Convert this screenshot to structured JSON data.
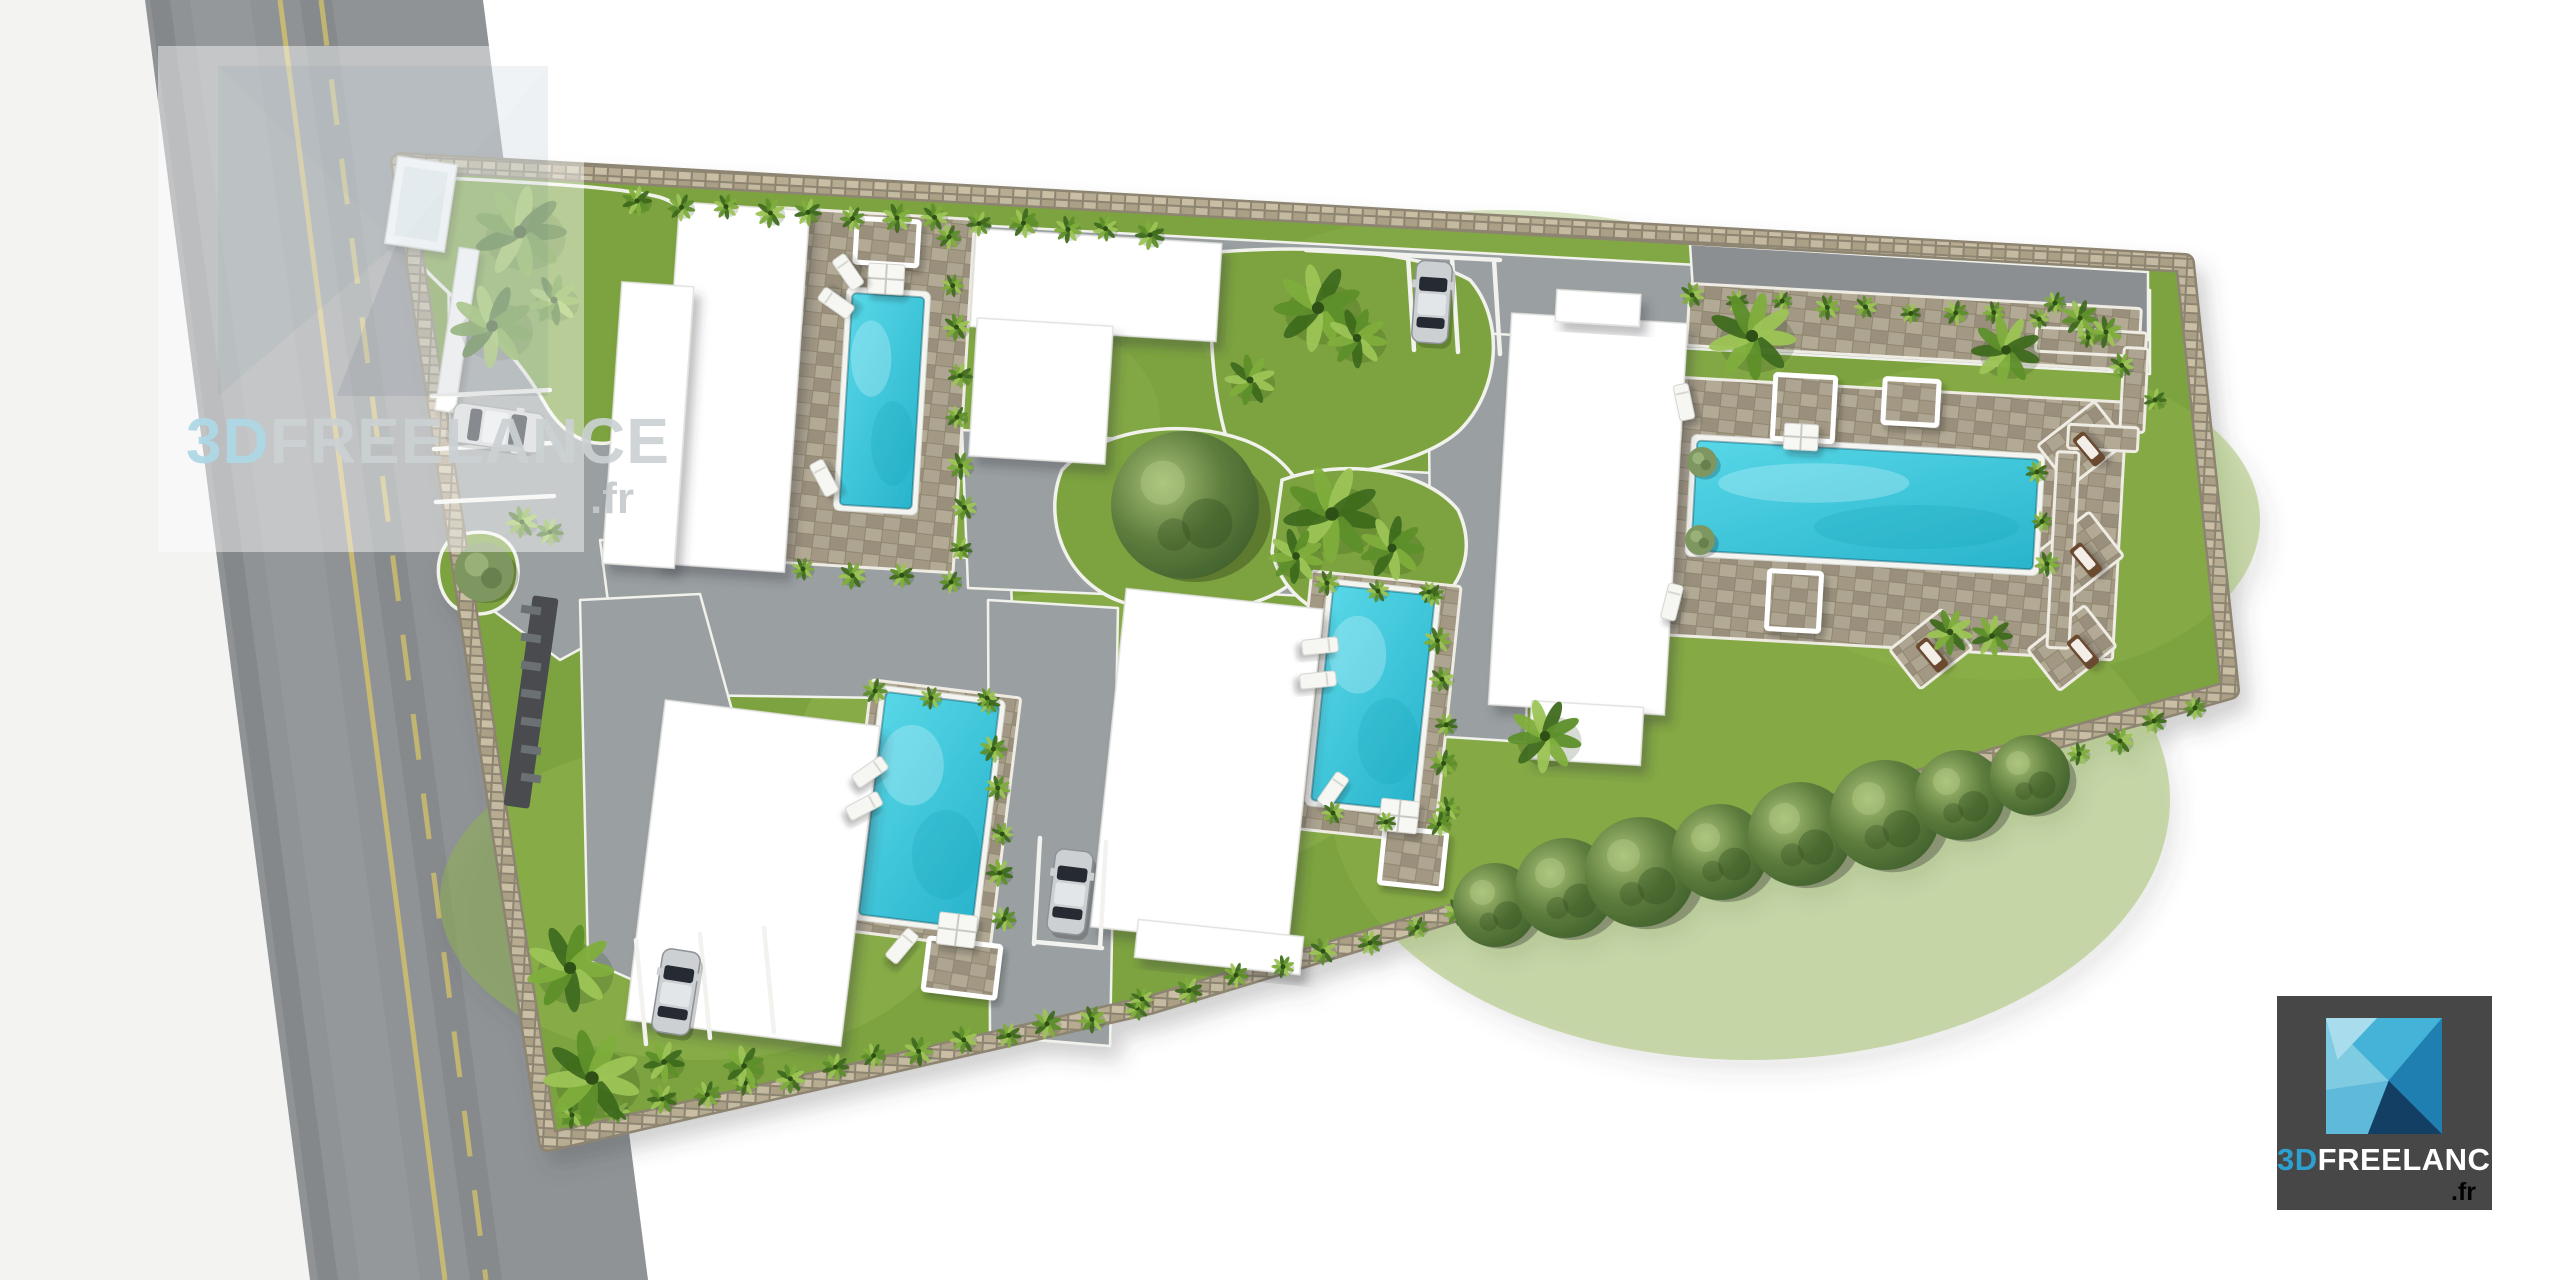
{
  "watermark": {
    "brand_3d": "3D",
    "brand_rest": "FREELANCE",
    "domain": ".fr"
  },
  "logo": {
    "brand_3d": "3D",
    "brand_rest": "FREELANCE",
    "domain": ".fr"
  },
  "palette": {
    "lawn": "#7ca33f",
    "lawn_light": "#8fb24c",
    "drive": "#9aa0a2",
    "drive_dark": "#8b8f92",
    "road": "#8f9396",
    "road_line": "#d2c06c",
    "pool_light": "#57d7e7",
    "pool_dark": "#29b4cc",
    "deck": "#a39a86",
    "wall": "#958d79",
    "wall_light": "#c4baa1",
    "building": "#ffffff",
    "curb": "#f2f2ec",
    "accent_blue": "#2da0cf",
    "logo_bg": "#474747"
  },
  "scene": {
    "road": {
      "pts": "145,0 483,0 648,1280 310,1280",
      "line_solid": [
        280,
        0,
        445,
        1280
      ],
      "line_dashed": [
        321,
        0,
        486,
        1280
      ]
    },
    "site": {
      "pts": "400,162 2185,263 2230,690 1530,890 1150,1005 548,1142"
    },
    "drives": [
      {
        "pts": "448,196 2150,290 2150,374 448,280"
      },
      {
        "pts": "448,252 628,238 652,610 560,660 452,580"
      },
      {
        "pts": "600,540 1010,560 1016,700 620,694"
      },
      {
        "pts": "962,430 1236,445 1240,600 968,588"
      },
      {
        "pts": "1225,462 1452,474 1456,604 1230,592"
      },
      {
        "pts": "1428,330 1532,336 1526,742 1432,736"
      },
      {
        "pts": "988,600 1118,608 1110,1046 990,1036"
      },
      {
        "pts": "580,600 700,594 790,920 700,1010 588,960"
      },
      {
        "pts": "1690,244 2148,272 2148,340 1694,306",
        "dark": true
      }
    ],
    "islands": [
      {
        "d": "M410,176 C520,182 610,186 655,196 C705,207 702,262 668,300 C642,332 652,378 650,420 C606,462 566,442 544,402 C506,336 456,304 422,266 C410,236 406,200 410,176 Z"
      },
      {
        "d": "M452,538 C492,522 520,540 518,574 C516,606 488,622 460,610 C436,600 430,556 452,538 Z"
      },
      {
        "d": "M1218,252 C1320,244 1420,252 1470,280 C1505,320 1500,390 1460,430 C1420,468 1300,490 1240,470 C1210,420 1205,300 1218,252 Z"
      },
      {
        "d": "M1062,470 C1102,428 1182,418 1244,440 C1304,462 1324,520 1302,572 C1272,612 1182,622 1122,602 C1064,582 1042,518 1062,470 Z"
      },
      {
        "d": "M1282,480 C1342,458 1424,468 1458,510 C1482,560 1452,612 1392,622 C1332,630 1284,602 1272,552 Z"
      }
    ],
    "decks": [
      [
        762,
        213,
        202,
        354,
        3.5
      ],
      [
        1616,
        388,
        504,
        258,
        3.2
      ],
      [
        1688,
        296,
        452,
        62,
        3.2
      ],
      [
        1298,
        578,
        150,
        258,
        6
      ],
      [
        856,
        688,
        150,
        252,
        7
      ],
      [
        2046,
        418,
        72,
        52,
        -38
      ],
      [
        2042,
        528,
        72,
        56,
        -38
      ],
      [
        2036,
        622,
        72,
        52,
        -38
      ],
      [
        1898,
        624,
        66,
        50,
        -38
      ],
      [
        2036,
        330,
        110,
        24,
        3
      ],
      [
        2122,
        348,
        24,
        84,
        3
      ],
      [
        2068,
        426,
        70,
        24,
        3
      ],
      [
        2052,
        452,
        22,
        196,
        3
      ]
    ],
    "pools": [
      [
        846,
        295,
        72,
        212,
        3.5
      ],
      [
        1694,
        450,
        342,
        110,
        3.2
      ],
      [
        1322,
        590,
        102,
        216,
        6
      ],
      [
        872,
        698,
        114,
        224,
        7
      ]
    ],
    "buildings": [
      [
        667,
        206,
        130,
        362,
        4
      ],
      [
        612,
        284,
        72,
        282,
        4
      ],
      [
        973,
        236,
        246,
        98,
        3.5
      ],
      [
        973,
        322,
        136,
        138,
        3.5
      ],
      [
        1500,
        318,
        176,
        392,
        3.4
      ],
      [
        1556,
        292,
        84,
        32,
        3.4
      ],
      [
        1530,
        704,
        112,
        58,
        3.4
      ],
      [
        1108,
        598,
        198,
        340,
        6
      ],
      [
        1136,
        928,
        166,
        38,
        6
      ],
      [
        645,
        712,
        216,
        322,
        7
      ]
    ],
    "pergolas": [
      [
        856,
        220,
        62,
        44,
        3.5
      ],
      [
        1774,
        376,
        60,
        64,
        3.2
      ],
      [
        1884,
        380,
        54,
        44,
        3.2
      ],
      [
        1768,
        572,
        52,
        58,
        3.2
      ],
      [
        1382,
        830,
        62,
        56,
        6
      ],
      [
        926,
        942,
        72,
        52,
        7
      ]
    ],
    "tables": [
      [
        868,
        264,
        36,
        30,
        3.5
      ],
      [
        1784,
        424,
        34,
        26,
        3.2
      ],
      [
        1380,
        800,
        38,
        32,
        6
      ],
      [
        938,
        914,
        38,
        32,
        7
      ]
    ],
    "loungers": [
      [
        848,
        272,
        -35,
        "w"
      ],
      [
        836,
        303,
        -55,
        "w"
      ],
      [
        824,
        478,
        -28,
        "w"
      ],
      [
        1684,
        402,
        -12,
        "w"
      ],
      [
        1672,
        602,
        14,
        "w"
      ],
      [
        2089,
        449,
        -40,
        "b"
      ],
      [
        2086,
        560,
        -40,
        "b"
      ],
      [
        2083,
        652,
        -40,
        "b"
      ],
      [
        1932,
        655,
        -40,
        "b"
      ],
      [
        1320,
        646,
        84,
        "w"
      ],
      [
        1318,
        680,
        84,
        "w"
      ],
      [
        1333,
        790,
        35,
        "w"
      ],
      [
        870,
        772,
        55,
        "w"
      ],
      [
        864,
        806,
        62,
        "w"
      ],
      [
        902,
        946,
        40,
        "w"
      ]
    ],
    "cars": [
      [
        498,
        428,
        40,
        92,
        98,
        "silver"
      ],
      [
        1432,
        302,
        36,
        82,
        4,
        "silver"
      ],
      [
        1070,
        892,
        38,
        84,
        7,
        "silver"
      ],
      [
        676,
        992,
        38,
        84,
        9,
        "silver"
      ]
    ],
    "bays": [
      [
        432,
        396,
        550,
        390
      ],
      [
        434,
        449,
        552,
        443
      ],
      [
        436,
        502,
        554,
        496
      ],
      [
        1408,
        256,
        1414,
        350
      ],
      [
        1452,
        258,
        1458,
        352
      ],
      [
        1494,
        260,
        1500,
        354
      ],
      [
        1306,
        250,
        1500,
        260
      ],
      [
        1040,
        838,
        1034,
        944
      ],
      [
        1106,
        842,
        1100,
        948
      ],
      [
        1036,
        942,
        1102,
        948
      ],
      [
        636,
        940,
        646,
        1044
      ],
      [
        700,
        934,
        710,
        1038
      ],
      [
        764,
        928,
        774,
        1032
      ]
    ],
    "hedges": [
      [
        640,
        204,
        1150,
        232,
        13,
        13
      ],
      [
        952,
        240,
        964,
        552,
        8,
        12
      ],
      [
        806,
        572,
        948,
        580,
        4,
        12
      ],
      [
        1695,
        298,
        2040,
        318,
        9,
        11
      ],
      [
        2040,
        475,
        2046,
        566,
        3,
        11
      ],
      [
        1436,
        598,
        1448,
        806,
        6,
        12
      ],
      [
        1330,
        586,
        1428,
        594,
        3,
        11
      ],
      [
        1336,
        816,
        1438,
        826,
        3,
        11
      ],
      [
        992,
        706,
        1004,
        916,
        6,
        12
      ],
      [
        878,
        694,
        986,
        700,
        3,
        11
      ],
      [
        575,
        1118,
        1135,
        1008,
        14,
        13
      ],
      [
        1145,
        1002,
        1460,
        915,
        8,
        12
      ],
      [
        2000,
        790,
        2195,
        705,
        6,
        12
      ],
      [
        2058,
        306,
        2152,
        398,
        4,
        11
      ]
    ],
    "palms": [
      [
        520,
        232,
        40
      ],
      [
        492,
        326,
        36
      ],
      [
        554,
        300,
        22
      ],
      [
        522,
        522,
        14
      ],
      [
        550,
        532,
        12
      ],
      [
        1318,
        308,
        38
      ],
      [
        1357,
        338,
        26
      ],
      [
        1250,
        380,
        22
      ],
      [
        1332,
        514,
        42
      ],
      [
        1392,
        548,
        28
      ],
      [
        1296,
        556,
        24
      ],
      [
        1752,
        336,
        38
      ],
      [
        2006,
        350,
        30
      ],
      [
        2080,
        318,
        16
      ],
      [
        2106,
        332,
        14
      ],
      [
        1950,
        632,
        20
      ],
      [
        1992,
        636,
        18
      ],
      [
        1545,
        736,
        32
      ],
      [
        570,
        968,
        38
      ],
      [
        592,
        1078,
        42
      ],
      [
        664,
        1062,
        18
      ],
      [
        744,
        1066,
        18
      ]
    ],
    "bushes": [
      [
        484,
        572,
        30
      ],
      [
        1702,
        462,
        15
      ],
      [
        1700,
        540,
        15
      ]
    ],
    "trees": [
      [
        1185,
        505,
        74
      ],
      [
        1495,
        905,
        42
      ],
      [
        1565,
        888,
        50
      ],
      [
        1640,
        872,
        55
      ],
      [
        1720,
        852,
        48
      ],
      [
        1800,
        834,
        52
      ],
      [
        1885,
        815,
        55
      ],
      [
        1960,
        795,
        45
      ],
      [
        2030,
        775,
        40
      ]
    ],
    "gate": [
      [
        391,
        160,
        60,
        88,
        8.5
      ],
      [
        447,
        248,
        20,
        164,
        8.5
      ]
    ],
    "drain": [
      518,
      596,
      26,
      212,
      8
    ]
  }
}
